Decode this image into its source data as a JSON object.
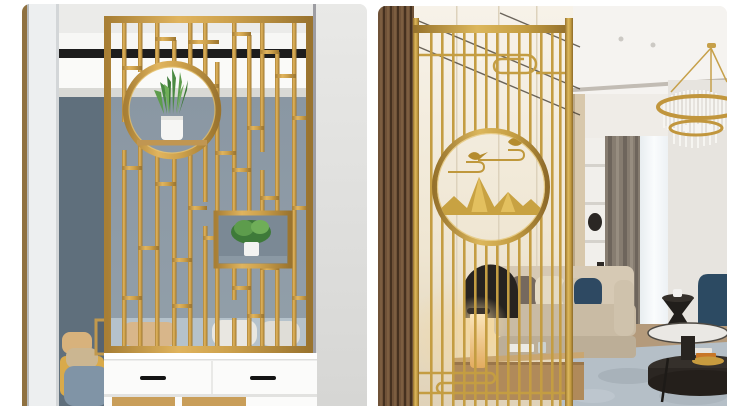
{
  "page": {
    "background_color": "#ffffff",
    "kind": "two interior product photos side by side, gold metal room divider screens, no visible text",
    "corner_radius_px": 8
  },
  "photos": [
    {
      "id": "left",
      "alt": "Gold geometric grille room divider screen with round opening holding a potted snake plant, mounted on a white two-drawer cabinet in front of a blue-grey wall",
      "palette": {
        "gold": "#cda14c",
        "gold_highlight": "#e8c878",
        "gold_shadow": "#a87f35",
        "wall_blue_grey": "#8d9aa5",
        "dark_side_wall": "#5f6f7c",
        "ceiling_white": "#f7f7f5",
        "dark_slot": "#1d1d1d",
        "cabinet_white": "#fbfbfa",
        "handle_black": "#141414",
        "sofa_blue": "#b5c2cb",
        "chair_yellow": "#d9aa4a",
        "pillow_tan": "#d8b27c",
        "plant_green": "#4a8a42",
        "pot_white": "#f6f6f4"
      },
      "features": [
        "gold grille screen",
        "circle medallion with snake plant on shelf",
        "shadow box with small plant",
        "white drawer cabinet with black handles",
        "sofa behind screen",
        "yellow armchair through doorway",
        "gold framed picture"
      ]
    },
    {
      "id": "right",
      "alt": "Gold vertical-bar room divider screen with round medallion of birds, clouds and mountains in a living room with beige sofa, curtains, crystal chandelier and round coffee tables",
      "palette": {
        "gold": "#c49d42",
        "gold_highlight": "#e2c06a",
        "wood_slat": "#6f5238",
        "cream_wall": "#f3ecdd",
        "ceiling_white": "#f5f3f0",
        "cove_light": "#f6e2b6",
        "curtain_taupe": "#867c70",
        "sheer_white": "#f1f4f6",
        "sofa_beige": "#d6c9b4",
        "pillow_navy": "#2e4962",
        "rug_blue_grey": "#b5bfc7",
        "floor_wood": "#b49a7b",
        "table_black": "#211e1b",
        "lamp_glow": "#f4d79b",
        "chair_teal": "#2c4a62",
        "bird_gold": "#b58c2e",
        "mountain_gold": "#c8a242"
      },
      "features": [
        "vertical bar gold screen",
        "circle medallion with gold birds, cloud scrolls and mountains",
        "ruyi cloud scroll motifs",
        "wood slat panel",
        "crystal ring chandelier",
        "beige sofa with navy pillow",
        "taupe curtain and sheer",
        "black hourglass side table",
        "two-tier round coffee table",
        "glowing cylinder lamp on wooden console"
      ]
    }
  ]
}
